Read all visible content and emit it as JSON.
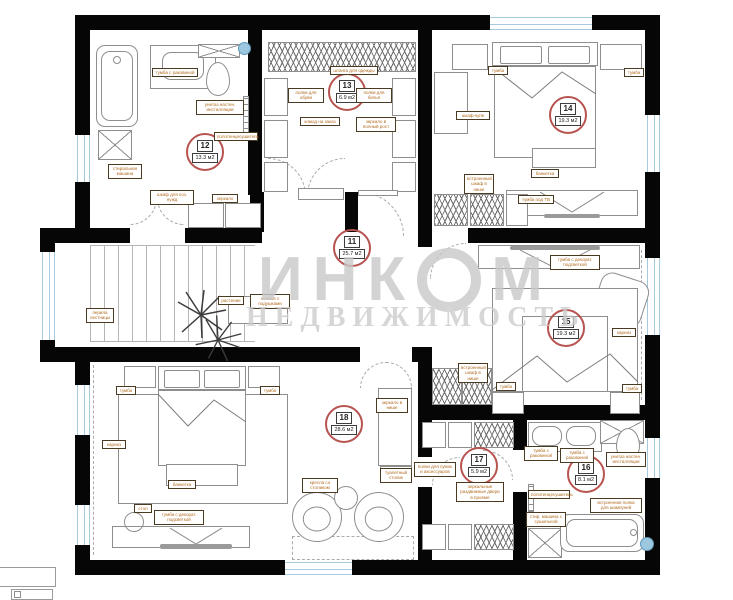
{
  "watermark": {
    "brand_left": "ИНК",
    "brand_right": "М",
    "subtitle": "НЕДВИЖИМОСТЬ"
  },
  "rooms": [
    {
      "number": "11",
      "area": "25.7 м2"
    },
    {
      "number": "12",
      "area": "13.3 м2"
    },
    {
      "number": "13",
      "area": "6.9 м2"
    },
    {
      "number": "14",
      "area": "19.3 м2"
    },
    {
      "number": "15",
      "area": "19.3 м2"
    },
    {
      "number": "16",
      "area": "8.1 м2"
    },
    {
      "number": "17",
      "area": "5.9 м2"
    },
    {
      "number": "18",
      "area": "28.6 м2"
    }
  ],
  "labels": {
    "r12_sink": "тумба с раковиной",
    "r12_wc": "унитаз настен. инсталляции",
    "r12_towel": "полотенцесушитель",
    "r12_dry": "стиральная машина",
    "r12_stor": "шкаф для хоз. нужд",
    "r12_mirror": "зеркало",
    "r13_rod": "штанга для одежды",
    "r13_shelf_l": "полки для обуви",
    "r13_shelf_r": "полки для белья",
    "r13_commode": "комод на заказ",
    "r13_mirror": "зеркало в полный рост",
    "r14_tumba_l": "тумба",
    "r14_tumba_r": "тумба",
    "r14_ward": "шкаф-купе",
    "r14_niche": "встроенный шкаф в нише",
    "r14_bench": "банкетка",
    "r14_tv": "тумба под ТВ",
    "r15_tv": "тумба с декорат. подсветкой",
    "r15_niche": "встроенный шкаф в нише",
    "r15_tumba_l": "тумба",
    "r15_tumba_r": "тумба",
    "r15_side": "карниз",
    "r11_plant": "растение",
    "r11_bench": "скамья с подушками",
    "r11_rail": "перила лестницы",
    "r17_shelves": "полки для сумок и аксессуаров",
    "r17_doors": "зеркальные раздвижные двери в проеме",
    "r16_sink1": "тумба с раковиной",
    "r16_sink2": "тумба с раковиной",
    "r16_wc": "унитаз настен. инсталляции",
    "r16_towel": "полотенцесушитель",
    "r16_wash": "стир. машина с сушильной",
    "r16_shelf": "встроенная полка для шампуней",
    "r18_tumba_l": "тумба",
    "r18_tumba_r": "тумба",
    "r18_curtain": "карниз",
    "r18_bench": "банкетка",
    "r18_table": "стол",
    "r18_tv": "тумба с декорат. подсветкой",
    "r18_chairs": "кресла со столиком",
    "r18_niche1": "зеркало в нише",
    "r18_niche2": "туалетный столик"
  }
}
